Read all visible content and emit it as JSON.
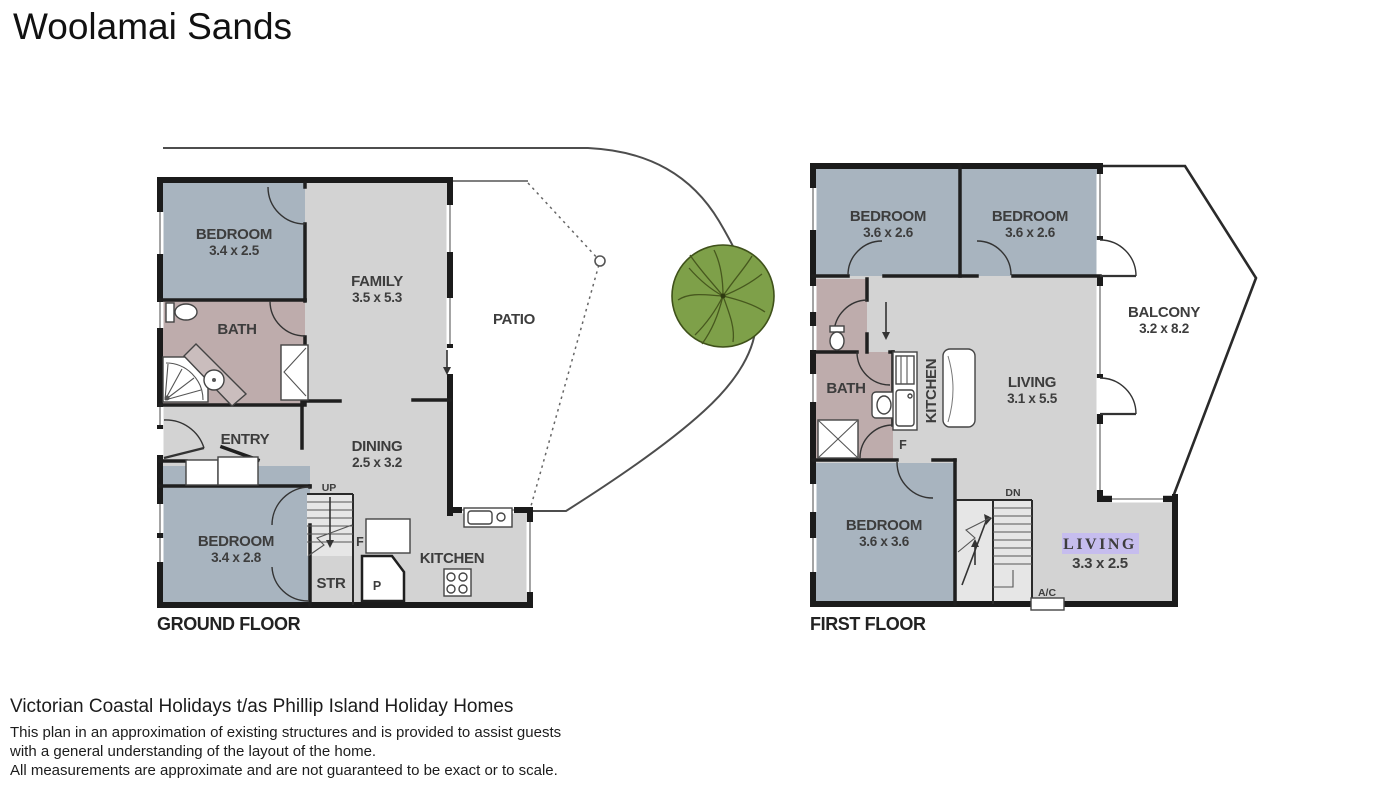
{
  "title": "Woolamai Sands",
  "ground_floor": {
    "floor_label": "GROUND FLOOR",
    "rooms": {
      "bedroom1": {
        "name": "BEDROOM",
        "dims": "3.4 x 2.5"
      },
      "bath": {
        "name": "BATH"
      },
      "family": {
        "name": "FAMILY",
        "dims": "3.5 x 5.3"
      },
      "patio": {
        "name": "PATIO"
      },
      "entry": {
        "name": "ENTRY"
      },
      "dining": {
        "name": "DINING",
        "dims": "2.5 x 3.2"
      },
      "bedroom2": {
        "name": "BEDROOM",
        "dims": "3.4 x 2.8"
      },
      "storage": {
        "name": "STR"
      },
      "kitchen": {
        "name": "KITCHEN"
      }
    },
    "markers": {
      "up": "UP",
      "fridge": "F",
      "pantry": "P"
    }
  },
  "first_floor": {
    "floor_label": "FIRST FLOOR",
    "rooms": {
      "bedroom1": {
        "name": "BEDROOM",
        "dims": "3.6 x 2.6"
      },
      "bedroom2": {
        "name": "BEDROOM",
        "dims": "3.6 x 2.6"
      },
      "balcony": {
        "name": "BALCONY",
        "dims": "3.2 x 8.2"
      },
      "bath": {
        "name": "BATH"
      },
      "kitchen": {
        "name": "KITCHEN"
      },
      "living": {
        "name": "LIVING",
        "dims": "3.1 x 5.5"
      },
      "bedroom3": {
        "name": "BEDROOM",
        "dims": "3.6 x 3.6"
      },
      "living2": {
        "name": "LIVING",
        "dims": "3.3 x 2.5"
      }
    },
    "markers": {
      "down": "DN",
      "fridge": "F",
      "ac": "A/C"
    }
  },
  "footer": {
    "company": "Victorian Coastal Holidays t/as Phillip Island Holiday Homes",
    "disclaimer_line1": "This plan in an approximation of existing structures and is provided to assist guests",
    "disclaimer_line2": "with a general understanding of the layout of the home.",
    "disclaimer_line3": "All measurements are approximate and are not guaranteed to be exact or to scale."
  },
  "colors": {
    "bedroom_fill": "#a8b4bf",
    "bath_fill": "#beacac",
    "floor_fill": "#d3d3d3",
    "wall": "#1b1b1b",
    "tree_fill": "#7ea049",
    "living_highlight_bg": "#c6bdee",
    "living_highlight_text": "#403e63",
    "boundary_line": "#4d4d4d"
  }
}
